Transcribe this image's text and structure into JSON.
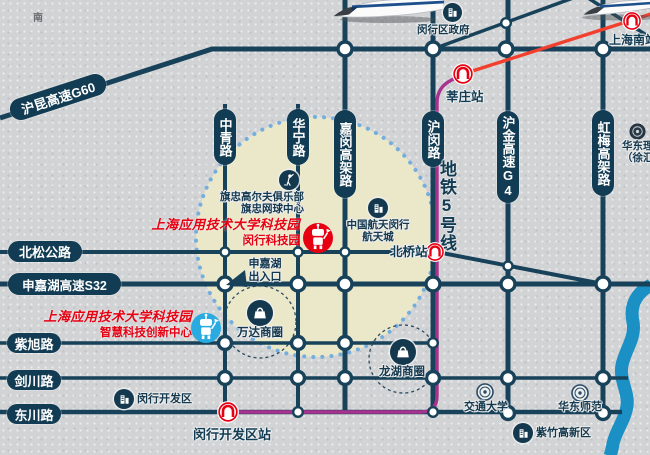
{
  "compass": {
    "south_label": "南"
  },
  "roads": {
    "g60_label": "沪昆高速G60",
    "vertical_labels": [
      "中青路",
      "华宁路",
      "嘉闵高架路",
      "沪闵路",
      "沪金高速G4",
      "虹梅高架路"
    ],
    "horizontal_labels": [
      "北松公路",
      "申嘉湖高速S32",
      "紫旭路",
      "剑川路",
      "东川路"
    ]
  },
  "metro": {
    "line5_label": "地铁5号线",
    "stations": {
      "xinzhuang": "莘庄站",
      "shanghai_south": "上海南站",
      "beiqiao": "北桥站",
      "minhang_dev_zone": "闵行开发区站"
    }
  },
  "tech_park": {
    "title": "上海应用技术大学科技园",
    "minhang_site_sub": "闵行科技园",
    "smart_innovation_sub": "智慧科技创新中心"
  },
  "pois": {
    "minhang_government": "闵行区政府",
    "golf_club_line1": "旗忠高尔夫俱乐部",
    "golf_club_line2": "旗忠网球中心",
    "aerospace_line1": "中国航天闵行",
    "aerospace_line2": "航天城",
    "expressway_exit_line1": "申嘉湖",
    "expressway_exit_line2": "出入口",
    "wanda_business_circle": "万达商圈",
    "longhu_business_circle": "龙湖商圈",
    "jiaotong_university": "交通大学",
    "east_china_normal": "华东师范",
    "zizhu_hitech_zone": "紫竹高新区",
    "minhang_dev_area": "闵行开发区",
    "ecust_line1": "华东理工",
    "ecust_line2": "（徐汇校区）"
  },
  "colors": {
    "road_navy": "#17425A",
    "pill_navy": "#123C53",
    "metro_line5": "#A8338F",
    "metro_line1_red": "#F2402F",
    "metro_logo_red": "#E60012",
    "highlight_zone_beige": "#EBE8C9",
    "zone_dot_border_blue": "#74AEDE",
    "river_blue": "#1B90C4",
    "background_gray": "#D2D3D5"
  }
}
